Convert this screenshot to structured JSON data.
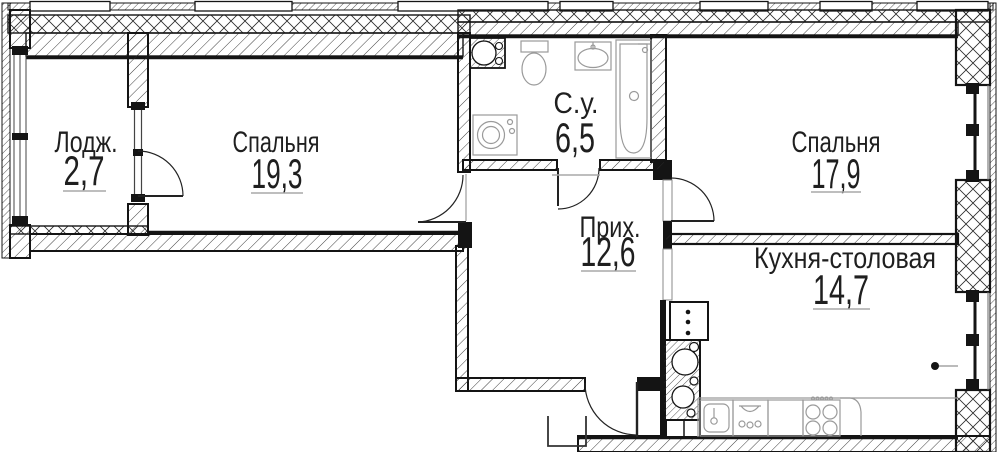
{
  "plan_title": "Apartment floor plan",
  "colors": {
    "wall": "#141414",
    "fixture": "#9a9a9a",
    "underline": "#a8a8a8",
    "background": "#ffffff"
  },
  "rooms": [
    {
      "key": "loggia",
      "name": "Лодж.",
      "area": "2,7"
    },
    {
      "key": "bedroom-1",
      "name": "Спальня",
      "area": "19,3"
    },
    {
      "key": "bathroom",
      "name": "С.у.",
      "area": "6,5"
    },
    {
      "key": "hallway",
      "name": "Прих.",
      "area": "12,6"
    },
    {
      "key": "bedroom-2",
      "name": "Спальня",
      "area": "17,9"
    },
    {
      "key": "kitchen-dining",
      "name": "Кухня-столовая",
      "area": "14,7"
    }
  ]
}
